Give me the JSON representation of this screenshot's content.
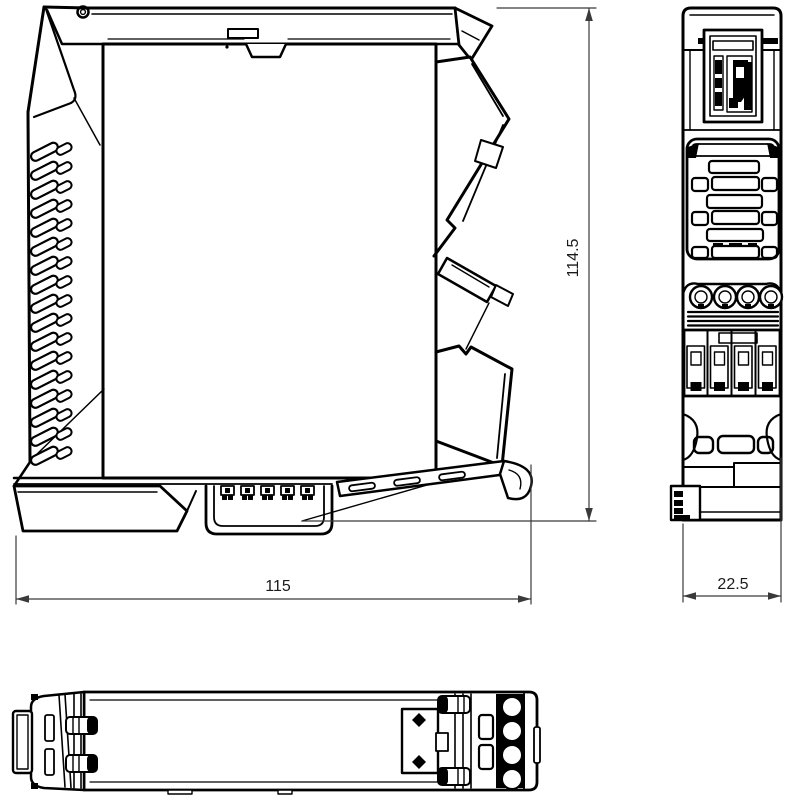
{
  "drawing": {
    "background_color": "#ffffff",
    "line_color": "#000000",
    "dimension_line_color": "#3a3a3a",
    "dimensions": {
      "width": {
        "label": "115"
      },
      "height": {
        "label": "114.5"
      },
      "depth": {
        "label": "22.5"
      }
    }
  }
}
